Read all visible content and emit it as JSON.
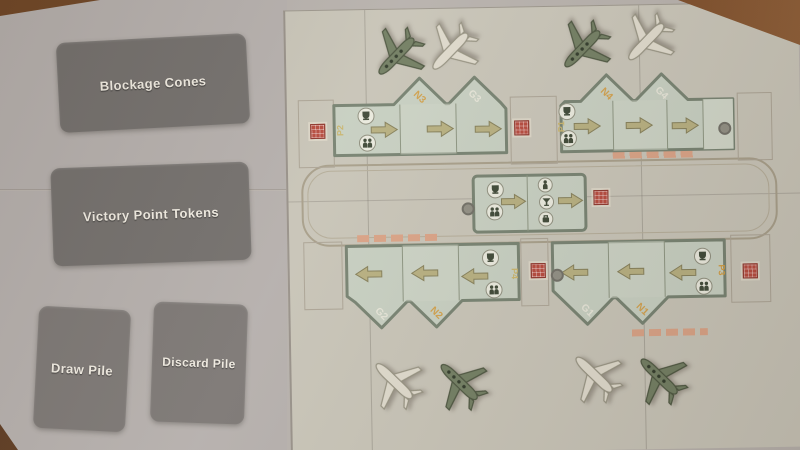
{
  "left_panel": {
    "slots": [
      {
        "label": "Blockage Cones"
      },
      {
        "label": "Victory Point Tokens"
      },
      {
        "label": "Draw Pile"
      },
      {
        "label": "Discard Pile"
      }
    ]
  },
  "board": {
    "gate_blocks": [
      {
        "name": "top-left",
        "inner_label": "P2",
        "arrow_direction": "right",
        "tile_icons": [
          "trophy",
          "passengers"
        ],
        "tips": [
          {
            "label": "N3",
            "label_color": "#d29a3d"
          },
          {
            "label": "G3",
            "label_color": "#e9e7da"
          }
        ]
      },
      {
        "name": "top-right",
        "inner_label": "P1",
        "arrow_direction": "right",
        "tile_icons": [
          "trophy",
          "passengers"
        ],
        "tips": [
          {
            "label": "N4",
            "label_color": "#d29a3d"
          },
          {
            "label": "G4",
            "label_color": "#e9e7da"
          }
        ]
      },
      {
        "name": "bottom-left",
        "inner_label": "P4",
        "arrow_direction": "left",
        "tile_icons": [
          "trophy",
          "passengers"
        ],
        "tips": [
          {
            "label": "G2",
            "label_color": "#e9e7da"
          },
          {
            "label": "N2",
            "label_color": "#d29a3d"
          }
        ]
      },
      {
        "name": "bottom-right",
        "inner_label": "P3",
        "arrow_direction": "left",
        "tile_icons": [
          "trophy",
          "passengers"
        ],
        "tips": [
          {
            "label": "G1",
            "label_color": "#e9e7da"
          },
          {
            "label": "N1",
            "label_color": "#d29a3d"
          }
        ]
      }
    ],
    "center_block": {
      "tiles": [
        {
          "icons": [
            "trophy",
            "passengers"
          ],
          "arrow": "right"
        },
        {
          "icons": [
            "passenger",
            "drink",
            "luggage"
          ],
          "arrow": "right"
        }
      ]
    },
    "airplanes": [
      {
        "area": "top-left",
        "color": "green"
      },
      {
        "area": "top-left",
        "color": "white"
      },
      {
        "area": "top-right",
        "color": "green"
      },
      {
        "area": "top-right",
        "color": "white"
      },
      {
        "area": "bottom-left",
        "color": "white"
      },
      {
        "area": "bottom-left",
        "color": "green"
      },
      {
        "area": "bottom-right",
        "color": "white"
      },
      {
        "area": "bottom-right",
        "color": "green"
      }
    ],
    "tokens": {
      "red_squares": 5,
      "gray_dots": 3
    }
  },
  "colors": {
    "mat": "#b4aeab",
    "board": "#c7c3b6",
    "card_slot": "#716d6a",
    "tile": "#c6cec0",
    "block_border": "#75806f",
    "accent_orange": "#d29a3d",
    "accent_red": "#b5473a",
    "plane_white": "#ded9cb",
    "plane_green": "#707c60",
    "wood": "#744626"
  }
}
